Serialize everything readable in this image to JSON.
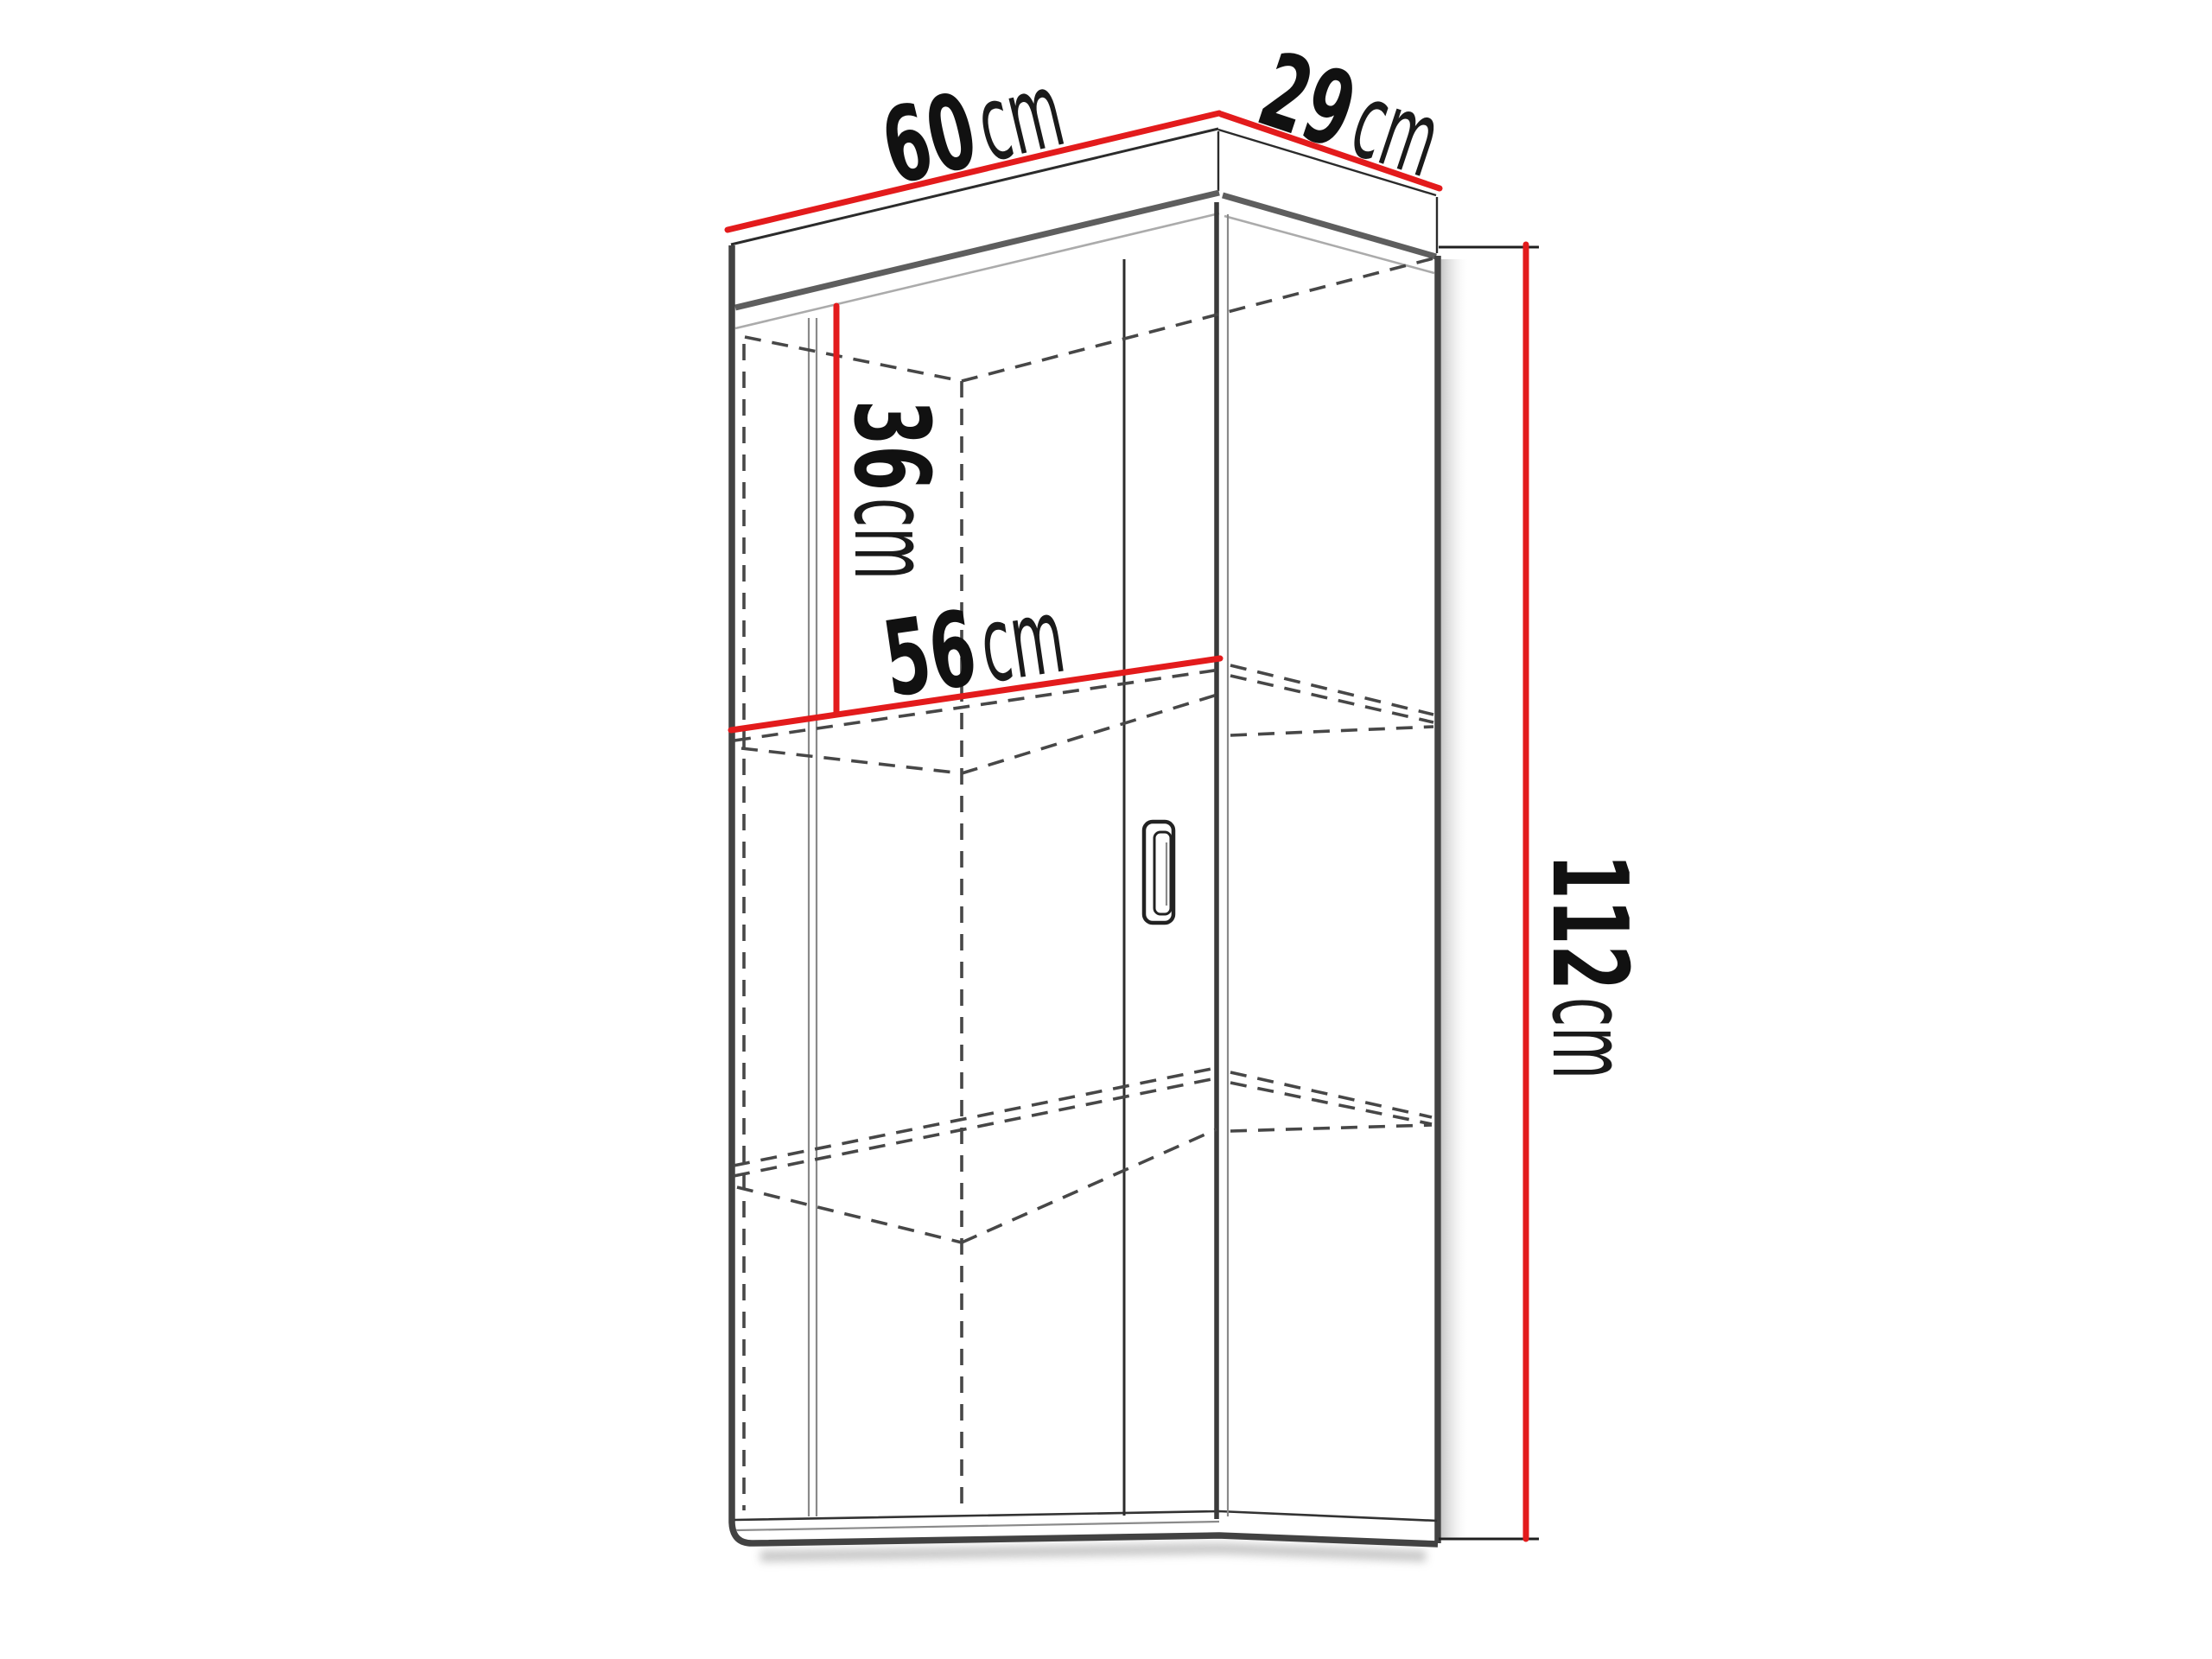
{
  "diagram": {
    "type": "furniture-dimension-diagram",
    "subject": "wall-hung display cabinet, perspective line drawing with red dimension lines",
    "labels": {
      "width": {
        "value": "60",
        "unit": "cm"
      },
      "depth": {
        "value": "29",
        "unit": "cm"
      },
      "upper_inner_height": {
        "value": "36",
        "unit": "cm"
      },
      "inner_width": {
        "value": "56",
        "unit": "cm"
      },
      "height": {
        "value": "112",
        "unit": "cm"
      }
    },
    "colors": {
      "dimension_line": "#e31b1c",
      "outline": "#2b2b2b",
      "edge": "#424242",
      "hidden_line": "#474747",
      "shadow": "#bdbdbd",
      "background": "#ffffff"
    }
  }
}
